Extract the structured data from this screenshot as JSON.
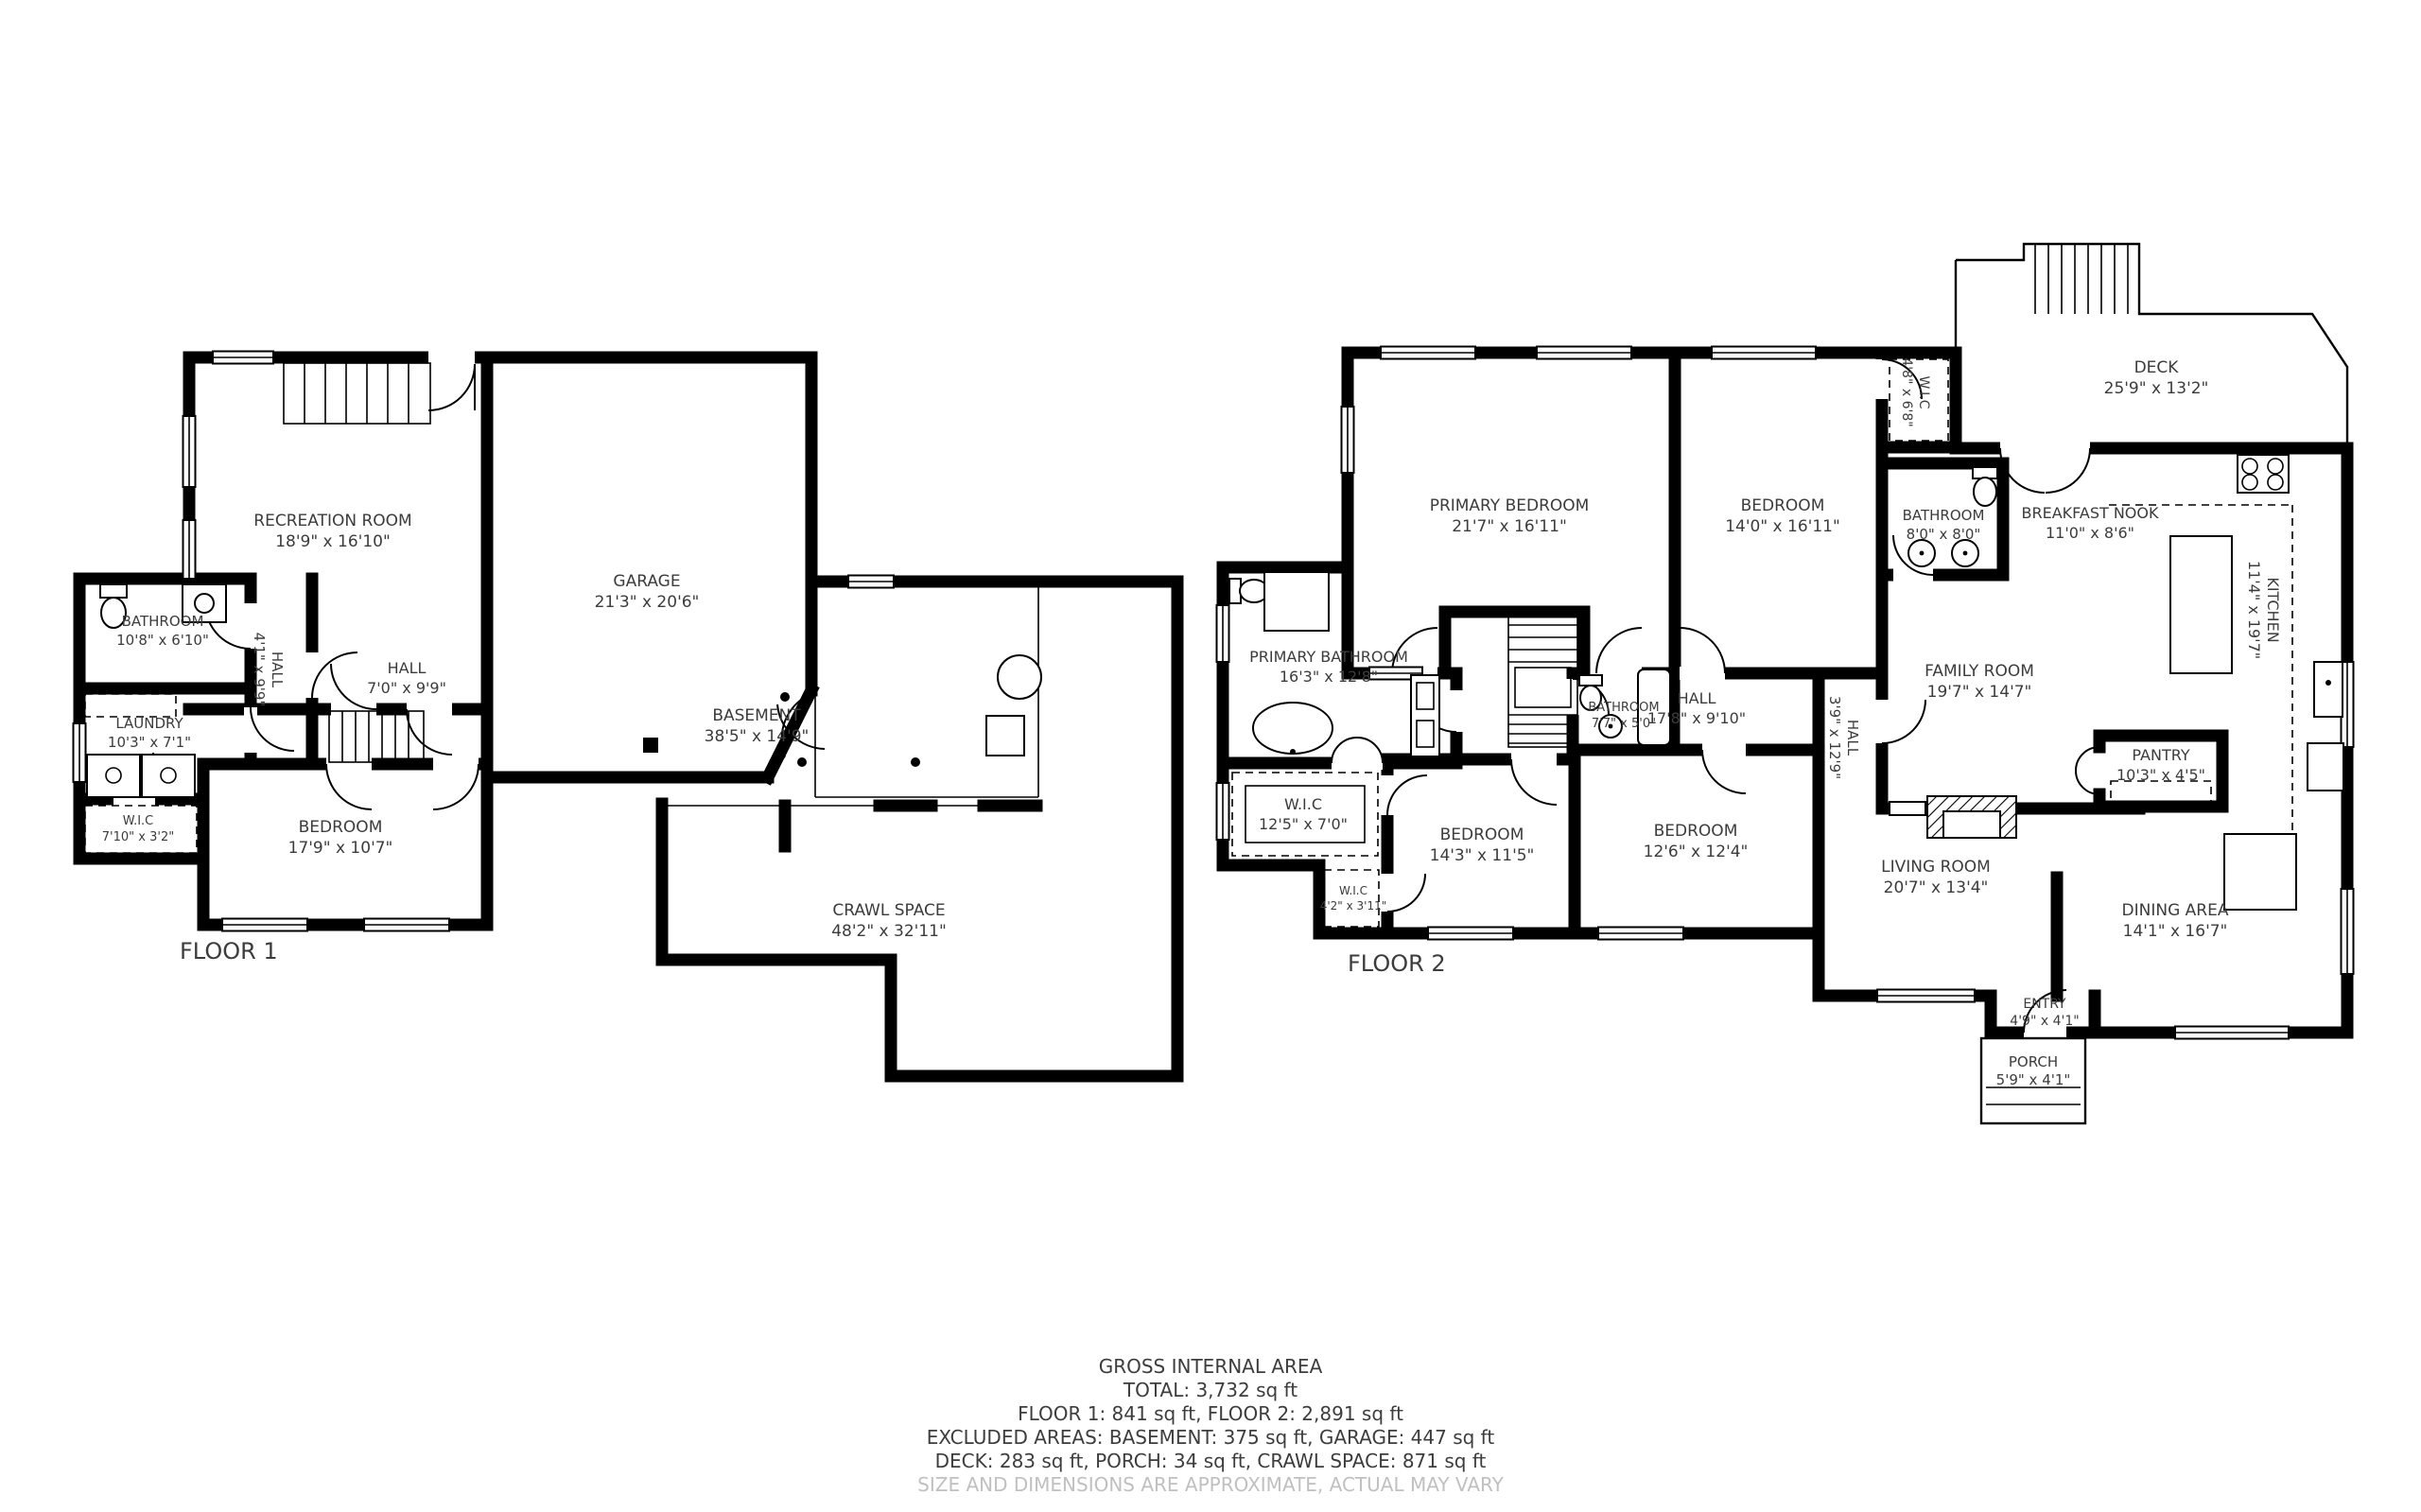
{
  "document_type": "floor-plan",
  "floor1": {
    "label": "FLOOR 1",
    "rooms": {
      "recreation": {
        "name": "RECREATION ROOM",
        "dims": "18'9\" x 16'10\""
      },
      "garage": {
        "name": "GARAGE",
        "dims": "21'3\" x 20'6\""
      },
      "bathroom": {
        "name": "BATHROOM",
        "dims": "10'8\" x 6'10\""
      },
      "hall_v": {
        "name": "HALL",
        "dims": "4'1\" x 9'9\""
      },
      "hall": {
        "name": "HALL",
        "dims": "7'0\" x 9'9\""
      },
      "laundry": {
        "name": "LAUNDRY",
        "dims": "10'3\" x 7'1\""
      },
      "wic": {
        "name": "W.I.C",
        "dims": "7'10\" x 3'2\""
      },
      "bedroom": {
        "name": "BEDROOM",
        "dims": "17'9\" x 10'7\""
      },
      "basement": {
        "name": "BASEMENT",
        "dims": "38'5\" x 14'9\""
      },
      "crawl": {
        "name": "CRAWL SPACE",
        "dims": "48'2\" x 32'11\""
      }
    }
  },
  "floor2": {
    "label": "FLOOR 2",
    "rooms": {
      "primary_bedroom": {
        "name": "PRIMARY BEDROOM",
        "dims": "21'7\" x 16'11\""
      },
      "bedroom2": {
        "name": "BEDROOM",
        "dims": "14'0\" x 16'11\""
      },
      "wic_top": {
        "name": "W.I.C",
        "dims": "4'8\" x 6'8\""
      },
      "bathroom_top": {
        "name": "BATHROOM",
        "dims": "8'0\" x 8'0\""
      },
      "deck": {
        "name": "DECK",
        "dims": "25'9\" x 13'2\""
      },
      "breakfast": {
        "name": "BREAKFAST NOOK",
        "dims": "11'0\" x 8'6\""
      },
      "kitchen": {
        "name": "KITCHEN",
        "dims": "11'4\" x 19'7\""
      },
      "family": {
        "name": "FAMILY ROOM",
        "dims": "19'7\" x 14'7\""
      },
      "primary_bath": {
        "name": "PRIMARY BATHROOM",
        "dims": "16'3\" x 12'8\""
      },
      "hall": {
        "name": "HALL",
        "dims": "17'8\" x 9'10\""
      },
      "bathroom_small": {
        "name": "BATHROOM",
        "dims": "7'7\" x 5'0\""
      },
      "wic_mid": {
        "name": "W.I.C",
        "dims": "12'5\" x 7'0\""
      },
      "wic_small": {
        "name": "W.I.C",
        "dims": "4'2\" x 3'11\""
      },
      "bedroom3": {
        "name": "BEDROOM",
        "dims": "14'3\" x 11'5\""
      },
      "bedroom4": {
        "name": "BEDROOM",
        "dims": "12'6\" x 12'4\""
      },
      "hall_v": {
        "name": "HALL",
        "dims": "3'9\" x 12'9\""
      },
      "pantry": {
        "name": "PANTRY",
        "dims": "10'3\" x 4'5\""
      },
      "living": {
        "name": "LIVING ROOM",
        "dims": "20'7\" x 13'4\""
      },
      "dining": {
        "name": "DINING AREA",
        "dims": "14'1\" x 16'7\""
      },
      "entry": {
        "name": "ENTRY",
        "dims": "4'9\" x 4'1\""
      },
      "porch": {
        "name": "PORCH",
        "dims": "5'9\" x 4'1\""
      }
    }
  },
  "summary": {
    "line1": "GROSS INTERNAL AREA",
    "line2": "TOTAL: 3,732 sq ft",
    "line3": "FLOOR 1: 841 sq ft, FLOOR 2: 2,891 sq ft",
    "line4": "EXCLUDED AREAS: BASEMENT: 375 sq ft, GARAGE: 447 sq ft",
    "line5": "DECK: 283 sq ft, PORCH: 34 sq ft, CRAWL SPACE: 871 sq ft",
    "line6": "SIZE AND DIMENSIONS ARE APPROXIMATE, ACTUAL MAY VARY"
  },
  "colors": {
    "wall": "#000000",
    "label": "#3c3c3c",
    "disclaimer": "#c0c0c0",
    "background": "#ffffff"
  }
}
